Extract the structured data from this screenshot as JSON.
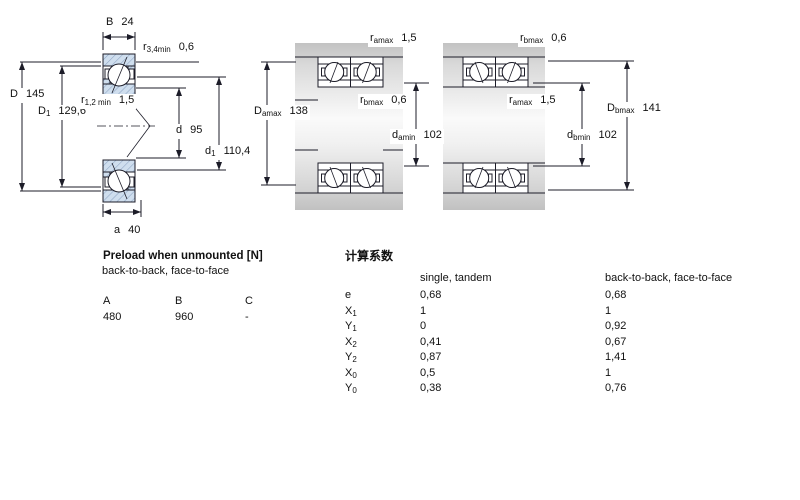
{
  "drawing": {
    "left_view": {
      "B": {
        "sym": "B",
        "sub": "",
        "val": "24"
      },
      "r34": {
        "sym": "r",
        "sub": "3,4min",
        "val": "0,6"
      },
      "D": {
        "sym": "D",
        "sub": "",
        "val": "145"
      },
      "D1": {
        "sym": "D",
        "sub": "1",
        "val": "129,6"
      },
      "r12": {
        "sym": "r",
        "sub": "1,2 min",
        "val": "1,5"
      },
      "d": {
        "sym": "d",
        "sub": "",
        "val": "95"
      },
      "d1": {
        "sym": "d",
        "sub": "1",
        "val": "110,4"
      },
      "a": {
        "sym": "a",
        "sub": "",
        "val": "40"
      }
    },
    "middle_view": {
      "ramax": {
        "sym": "r",
        "sub": "amax",
        "val": "1,5"
      },
      "Damax": {
        "sym": "D",
        "sub": "amax",
        "val": "138"
      },
      "rbmax": {
        "sym": "r",
        "sub": "bmax",
        "val": "0,6"
      },
      "damin": {
        "sym": "d",
        "sub": "amin",
        "val": "102"
      }
    },
    "right_view": {
      "rbmax": {
        "sym": "r",
        "sub": "bmax",
        "val": "0,6"
      },
      "ramax": {
        "sym": "r",
        "sub": "amax",
        "val": "1,5"
      },
      "Dbmax": {
        "sym": "D",
        "sub": "bmax",
        "val": "141"
      },
      "dbmin": {
        "sym": "d",
        "sub": "bmin",
        "val": "102"
      }
    }
  },
  "preload": {
    "title": "Preload when unmounted [N]",
    "subtitle": "back-to-back, face-to-face",
    "columns": [
      "A",
      "B",
      "C"
    ],
    "values": [
      "480",
      "960",
      "-"
    ]
  },
  "factors": {
    "title": "计算系数",
    "col_single": "single, tandem",
    "col_paired": "back-to-back, face-to-face",
    "rows": [
      {
        "sym": "e",
        "sub": "",
        "v1": "0,68",
        "v2": "0,68"
      },
      {
        "sym": "X",
        "sub": "1",
        "v1": "1",
        "v2": "1"
      },
      {
        "sym": "Y",
        "sub": "1",
        "v1": "0",
        "v2": "0,92"
      },
      {
        "sym": "X",
        "sub": "2",
        "v1": "0,41",
        "v2": "0,67"
      },
      {
        "sym": "Y",
        "sub": "2",
        "v1": "0,87",
        "v2": "1,41"
      },
      {
        "sym": "X",
        "sub": "0",
        "v1": "0,5",
        "v2": "1"
      },
      {
        "sym": "Y",
        "sub": "0",
        "v1": "0,38",
        "v2": "0,76"
      }
    ]
  },
  "colors": {
    "ring_fill": "#cfdeee",
    "ring_hatch": "#8fa6c4",
    "line": "#1c1c28",
    "metal_gray": "#c6c6c6"
  }
}
